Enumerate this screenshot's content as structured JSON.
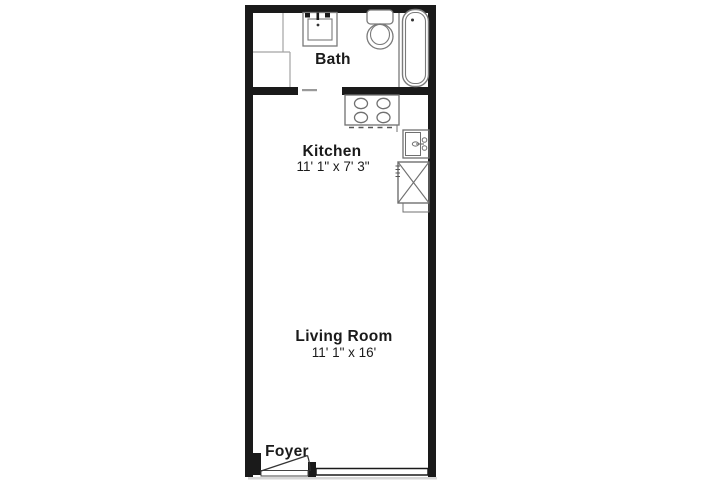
{
  "floor_plan": {
    "rooms": {
      "bath": {
        "label": "Bath"
      },
      "kitchen": {
        "label": "Kitchen",
        "dimensions": "11' 1\" x 7' 3\""
      },
      "living_room": {
        "label": "Living Room",
        "dimensions": "11' 1\" x 16'"
      },
      "foyer": {
        "label": "Foyer"
      }
    },
    "fixtures": [
      "vanity-sink-icon",
      "toilet-icon",
      "bathtub-icon",
      "closet-icon",
      "stove-icon",
      "kitchen-sink-icon",
      "refrigerator-icon",
      "entry-door-icon",
      "window-icon"
    ],
    "colors": {
      "wall": "#1a1a1a",
      "fixture_outline": "#7a7a7a",
      "partition": "#a3a3a3",
      "text": "#1a1a1a",
      "background": "#ffffff"
    }
  }
}
